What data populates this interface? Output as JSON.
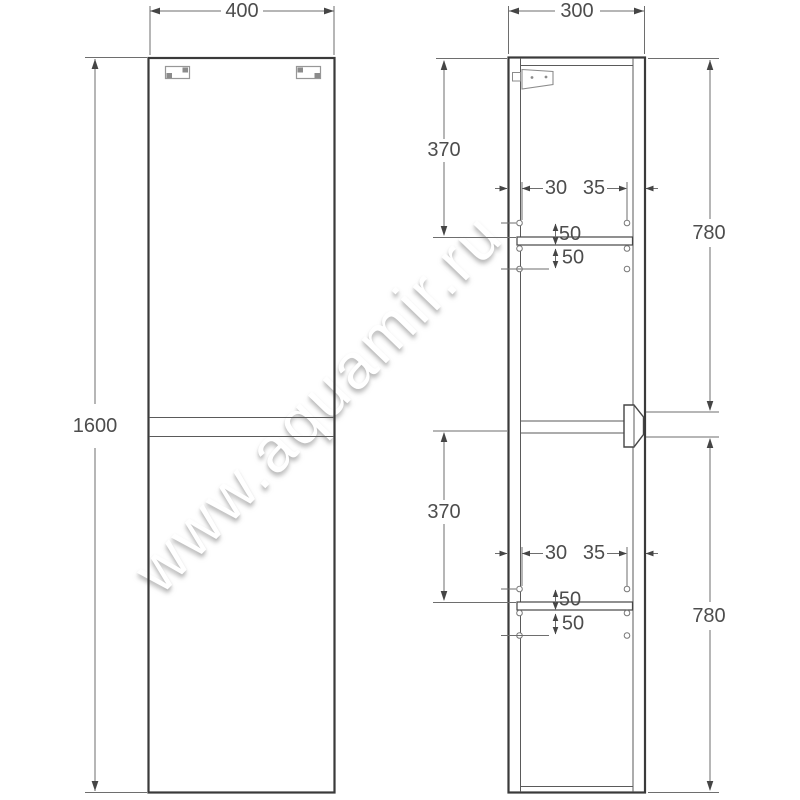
{
  "watermark": {
    "text": "www.aquamir.ru"
  },
  "front_view": {
    "width": "400",
    "height": "1600"
  },
  "side_view": {
    "depth": "300",
    "sections": [
      {
        "inner_height": "370",
        "door_height": "780",
        "hole_offset_back": "30",
        "hole_offset_front": "35",
        "hole_above_shelf": "50",
        "hole_below_shelf": "50"
      },
      {
        "inner_height": "370",
        "door_height": "780",
        "hole_offset_back": "30",
        "hole_offset_front": "35",
        "hole_above_shelf": "50",
        "hole_below_shelf": "50"
      }
    ]
  }
}
